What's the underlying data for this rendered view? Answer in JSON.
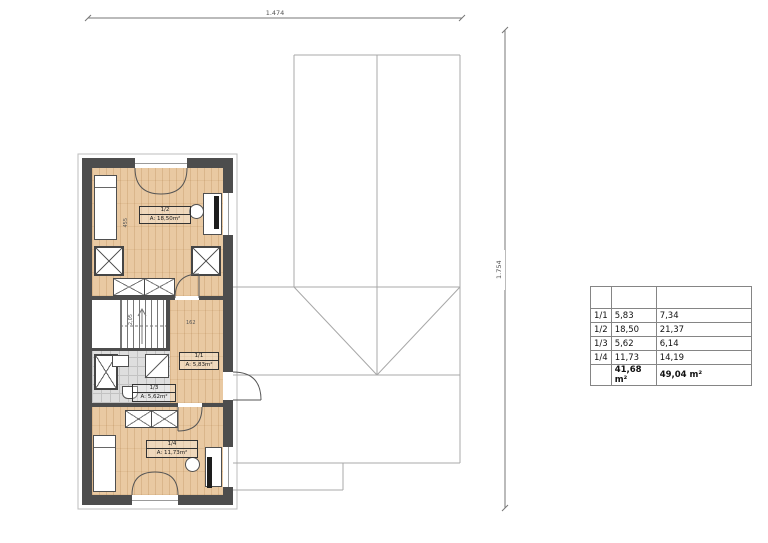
{
  "dimensions": {
    "top": "1.474",
    "right": "1.754"
  },
  "floor_plan": {
    "rooms": [
      {
        "id": "1/2",
        "area": "A: 18,50m²"
      },
      {
        "id": "1/1",
        "area": "A: 5,83m²"
      },
      {
        "id": "1/3",
        "area": "A: 5,62m²"
      },
      {
        "id": "1/4",
        "area": "A: 11,73m²"
      }
    ],
    "annotations": {
      "room_depth": "455",
      "stair_headroom": "2,05",
      "hall_width": "162"
    }
  },
  "area_table": {
    "rows": [
      {
        "id": "1/1",
        "floor": "5,83",
        "gross": "7,34"
      },
      {
        "id": "1/2",
        "floor": "18,50",
        "gross": "21,37"
      },
      {
        "id": "1/3",
        "floor": "5,62",
        "gross": "6,14"
      },
      {
        "id": "1/4",
        "floor": "11,73",
        "gross": "14,19"
      }
    ],
    "total": {
      "floor": "41,68 m²",
      "gross": "49,04 m²"
    }
  },
  "colors": {
    "wall": "#4d4d4d",
    "wood": "#e9c9a2",
    "tile": "#dedede",
    "roof_line": "#a0a0a0"
  }
}
